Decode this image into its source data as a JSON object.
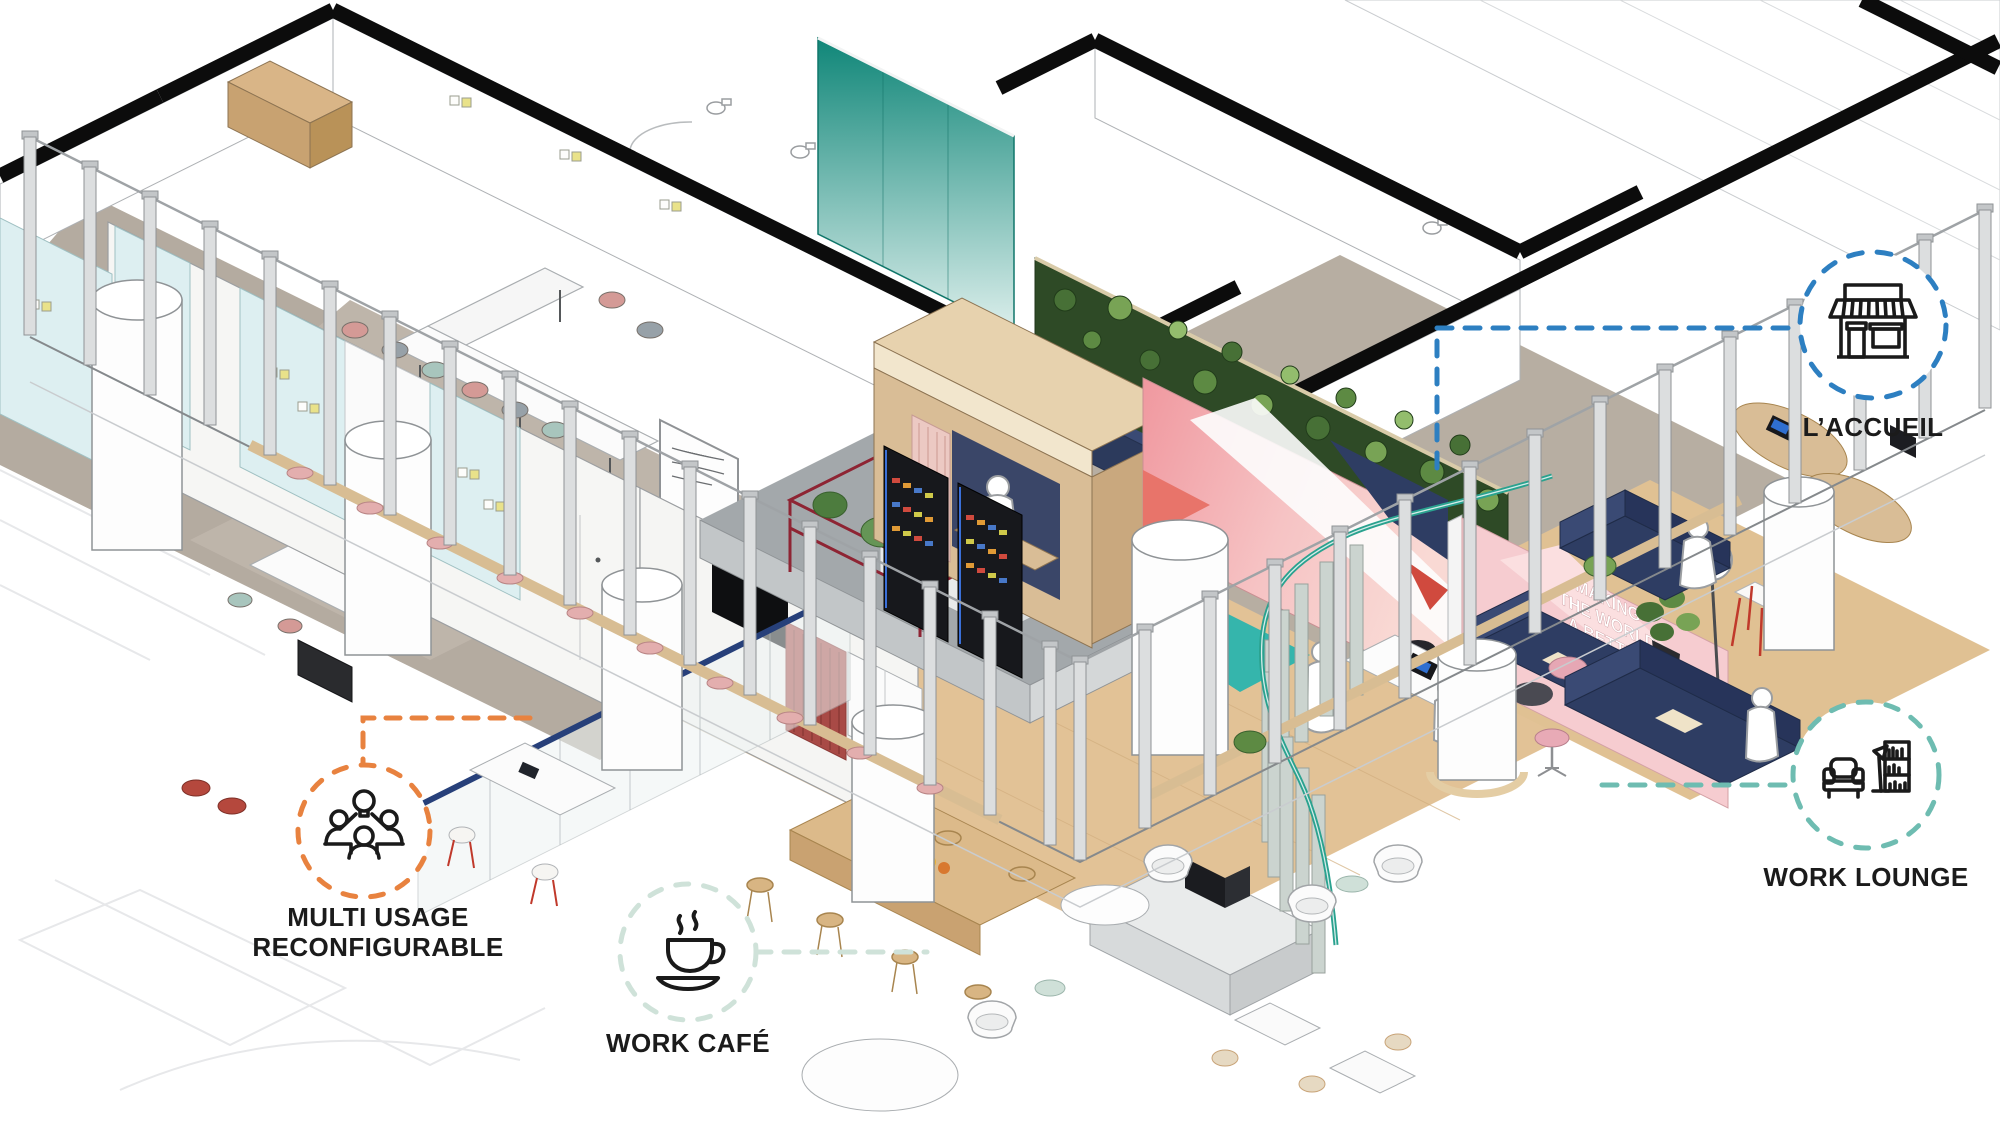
{
  "callouts": {
    "accueil": {
      "label": "L’ACCUEIL",
      "accent": "#2d7fc1",
      "icon": "storefront-icon"
    },
    "multi_usage": {
      "line1": "MULTI USAGE",
      "line2": "RECONFIGURABLE",
      "accent": "#e8823f",
      "icon": "brainstorm-people-icon"
    },
    "work_cafe": {
      "label": "WORK CAFÉ",
      "accent": "#cfe2d9",
      "icon": "coffee-cup-icon"
    },
    "work_lounge": {
      "label": "WORK LOUNGE",
      "accent": "#6ebcb1",
      "icon": "armchair-bookshelf-icon"
    }
  },
  "mural": {
    "lines": [
      "MAKING",
      "THE WORLD",
      "A BETTER",
      "HOME"
    ]
  },
  "palette": {
    "accent_blue": "#2d7fc1",
    "accent_orange": "#e8823f",
    "accent_teal": "#6ebcb1",
    "accent_mint": "#cfe2d9",
    "teal_glass": "#0f8678",
    "aqua_glass": "#ddeff1",
    "carpet_grey": "#b4aba0",
    "wood_floor": "#e2c296",
    "burgundy_rack": "#8e2433",
    "navy_sofa": "#2e3d63",
    "plant_green": "#477036",
    "mural_pink": "#f3b9bd",
    "curtain_red": "#a84a46",
    "teal_rail": "#2aa28f",
    "facade_grey": "#dcdedf"
  }
}
